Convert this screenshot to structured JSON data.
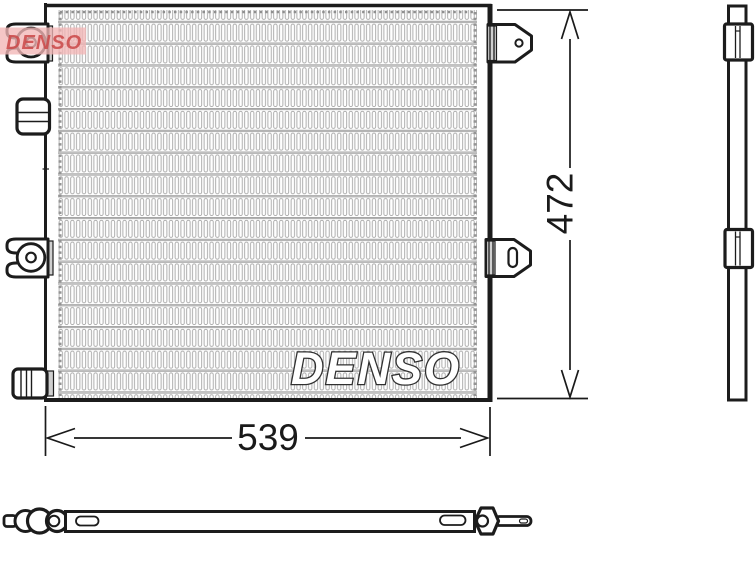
{
  "drawing": {
    "watermark": "DENSO",
    "corner_watermark": "DENSO",
    "dimensions": {
      "width": "539",
      "height": "472"
    },
    "colors": {
      "line": "#1c1c1c",
      "fin_line": "#a6a6a6",
      "shade": "#cfcfcf",
      "watermark_outline": "#303030",
      "corner_red": "#cb4848",
      "corner_bg": "#f2b6b6",
      "background": "#ffffff"
    }
  }
}
